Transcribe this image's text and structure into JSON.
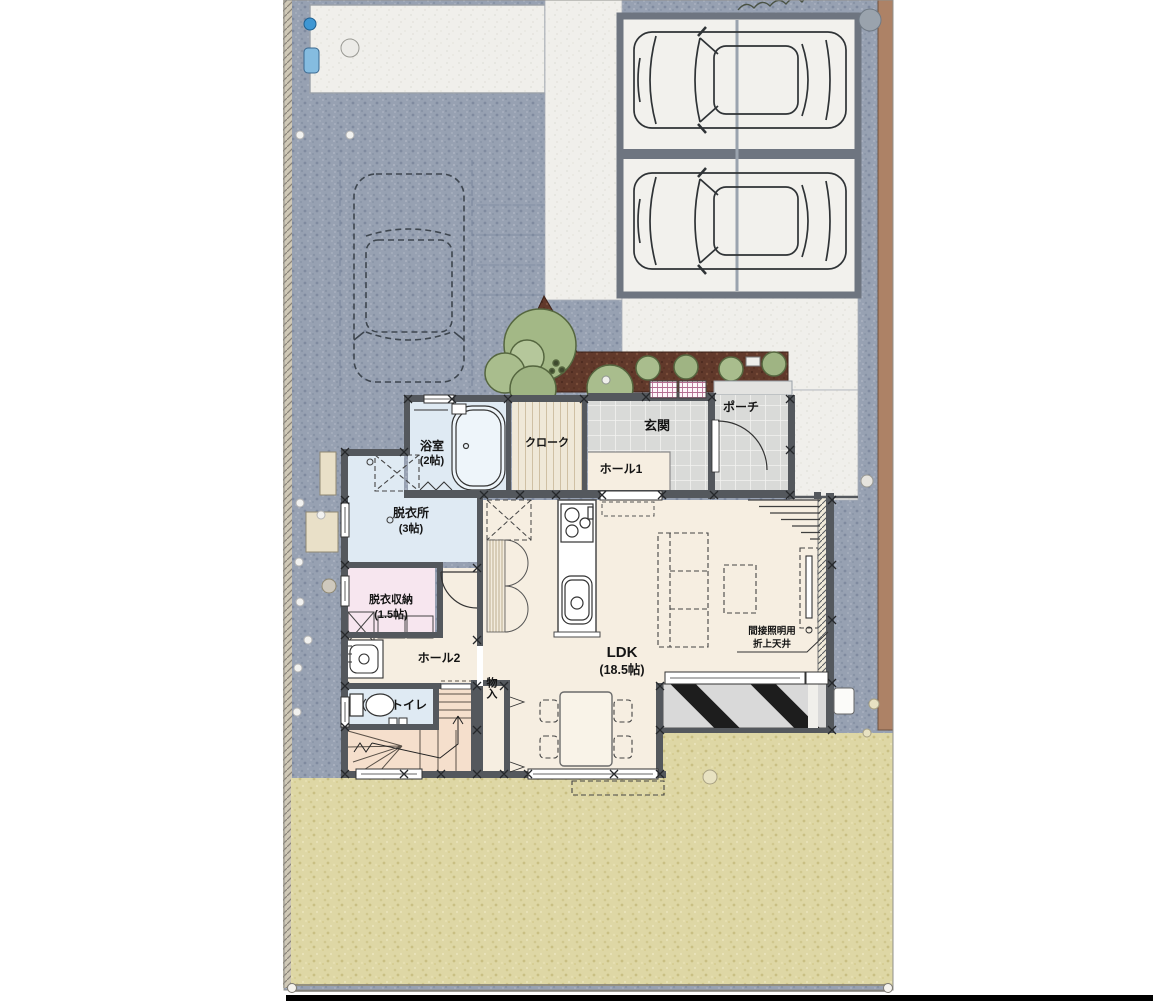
{
  "rooms": {
    "bath": {
      "label": "浴室",
      "size": "(2帖)"
    },
    "cloak": {
      "label": "クローク"
    },
    "genkan": {
      "label": "玄関"
    },
    "porch": {
      "label": "ポーチ"
    },
    "hall1": {
      "label": "ホール1"
    },
    "dressing": {
      "label": "脱衣所",
      "size": "(3帖)"
    },
    "dressing_storage": {
      "label": "脱衣収納",
      "size": "(1.5帖)"
    },
    "hall2": {
      "label": "ホール2"
    },
    "toilet": {
      "label": "トイレ"
    },
    "storage": {
      "label": "物入"
    },
    "ldk": {
      "label": "LDK",
      "size": "(18.5帖)"
    }
  },
  "annotations": {
    "indirect_lighting_line1": "間接照明用",
    "indirect_lighting_line2": "折上天井"
  },
  "colors": {
    "gravel": "#97a1b2",
    "concrete": "#f0efeb",
    "garden": "#ded7a5",
    "soil": "#61392b",
    "shrub": "#a9bd8d",
    "wall": "#54585d",
    "room_cream": "#f6eee1",
    "room_blue": "#dfeaf3",
    "room_pink": "#f7e6ef",
    "stair_peach": "#f5dfcc",
    "tile": "#d9dad8",
    "deck": "#d9d9d9",
    "edge_brown": "#ad8266",
    "water_blue": "#4a9fd4"
  }
}
